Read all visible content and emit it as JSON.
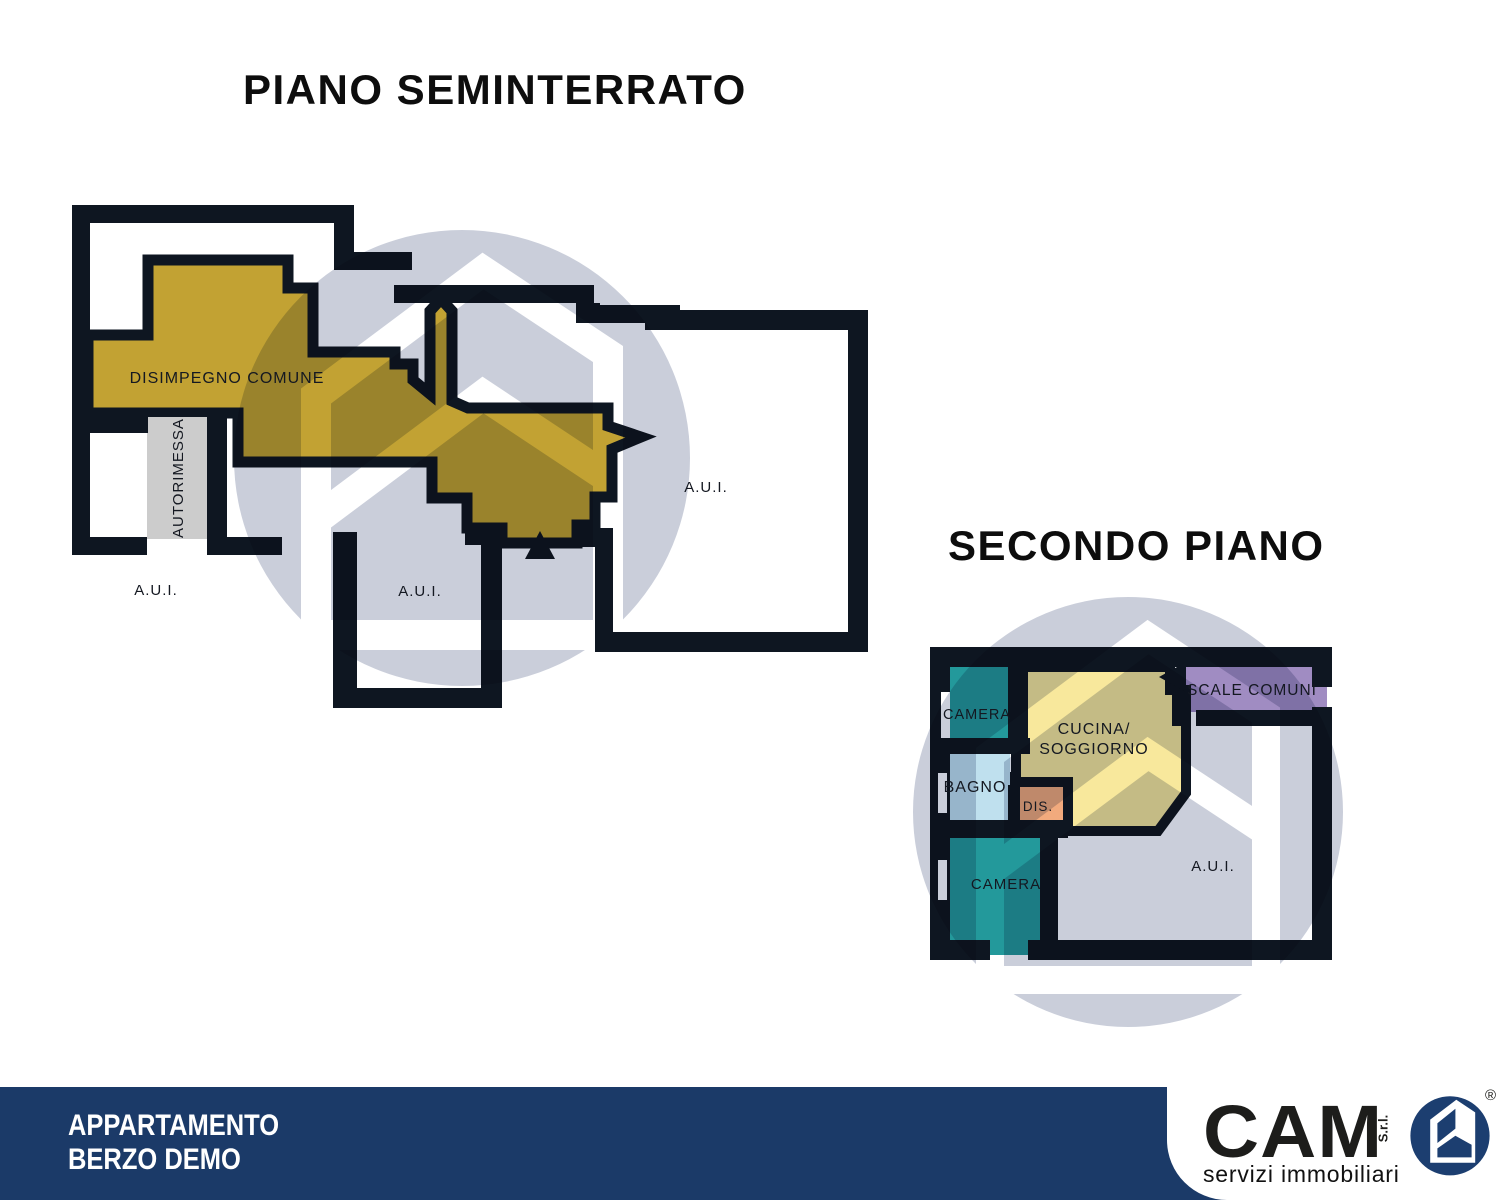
{
  "floors": [
    {
      "title": "PIANO SEMINTERRATO",
      "labels": {
        "disimpegno": "DISIMPEGNO COMUNE",
        "autorimessa": "AUTORIMESSA",
        "aui_left": "A.U.I.",
        "aui_center": "A.U.I.",
        "aui_right": "A.U.I."
      }
    },
    {
      "title": "SECONDO PIANO",
      "labels": {
        "camera_top": "CAMERA",
        "bagno": "BAGNO",
        "dis": "DIS.",
        "cucina_line1": "CUCINA/",
        "cucina_line2": "SOGGIORNO",
        "scale_comuni": "SCALE COMUNI",
        "camera_bottom": "CAMERA",
        "aui": "A.U.I."
      }
    }
  ],
  "footer": {
    "line1": "APPARTAMENTO",
    "line2": "BERZO DEMO"
  },
  "logo": {
    "brand": "CAM",
    "suffix": "S.r.l.",
    "registered": "®",
    "tagline": "servizi immobiliari"
  },
  "colors": {
    "gold": "#c2a233",
    "yellow": "#f8e89c",
    "teal": "#23999b",
    "bagno_blue": "#bfe0ee",
    "orange": "#f2aa7d",
    "purple": "#a08cc2",
    "garage_gray": "#cccccc",
    "navy": "#1b3a68",
    "wall": "#0e1621",
    "watermark": "#a9b0c4",
    "logo_navy": "#1c3e70"
  }
}
